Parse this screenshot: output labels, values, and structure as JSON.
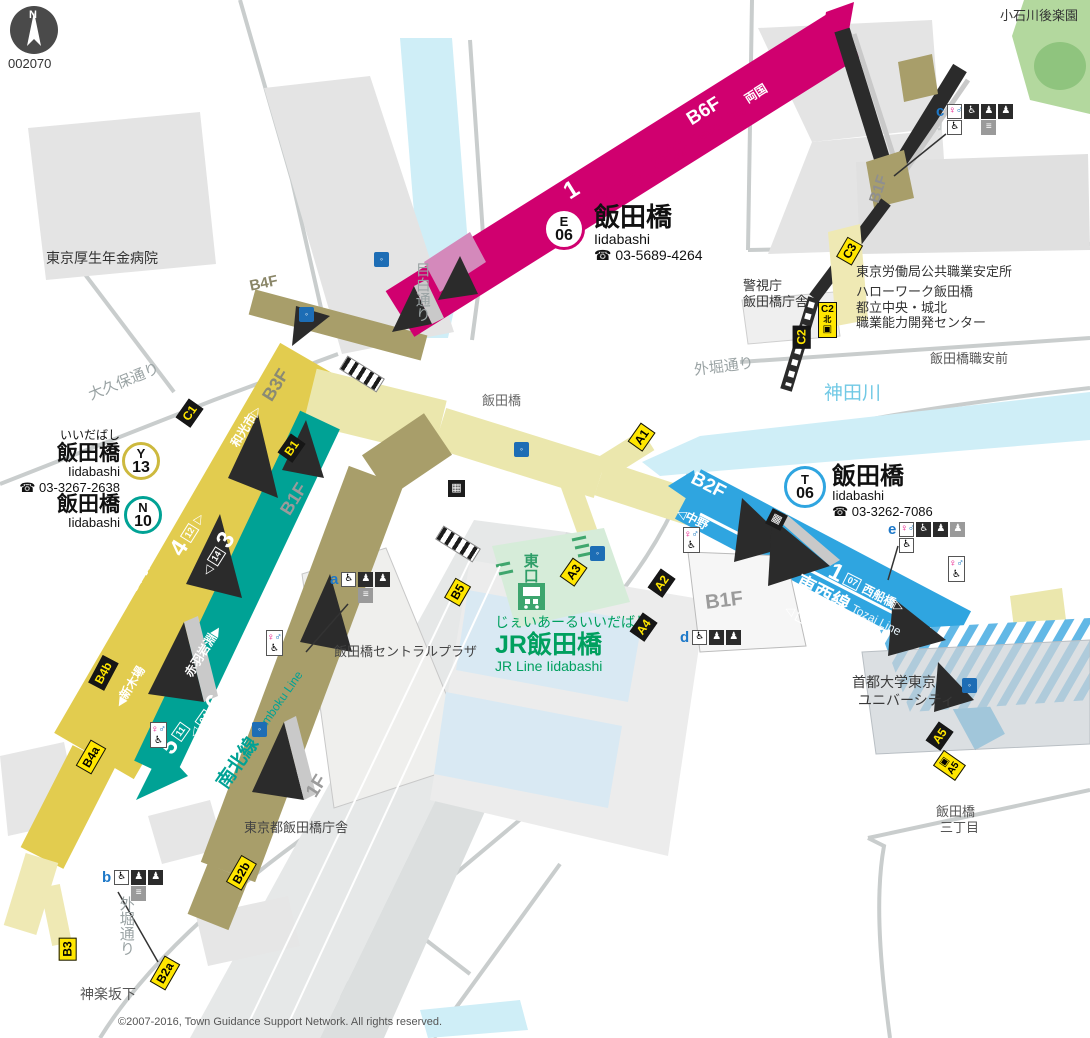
{
  "compass": {
    "n": "N",
    "code": "002070"
  },
  "copyright": "©2007-2016, Town Guidance Support Network. All rights reserved.",
  "glyphs": {
    "tri_l": "◁",
    "tri_r": "▷",
    "tri_l_solid": "◀",
    "tri_r_solid": "▶"
  },
  "icons": {
    "female": "♀",
    "male": "♂",
    "wheelchair": "♿",
    "locker": "▦",
    "person": "♟",
    "stairs": "≡",
    "elevator": "▣",
    "water": "◦",
    "train_label": "JR"
  },
  "stations": {
    "oedo": {
      "symbol": "E",
      "number": "06",
      "name": "飯田橋",
      "romaji": "Iidabashi",
      "phone": "☎ 03-5689-4264"
    },
    "yurakucho": {
      "symbol": "Y",
      "number": "13",
      "kana": "いいだばし",
      "name": "飯田橋",
      "romaji": "Iidabashi",
      "phone": "☎ 03-3267-2638"
    },
    "namboku": {
      "symbol": "N",
      "number": "10",
      "name": "飯田橋",
      "romaji": "Iidabashi"
    },
    "tozai": {
      "symbol": "T",
      "number": "06",
      "name": "飯田橋",
      "romaji": "Iidabashi",
      "phone": "☎ 03-3262-7086"
    },
    "jr": {
      "kana": "じぇいあーるいいだばし",
      "name": "JR飯田橋",
      "romaji": "JR Line Iidabashi",
      "east_exit": "東口"
    }
  },
  "lines": {
    "oedo": {
      "name": "都営大江戸線",
      "name_en": "Oedo Line",
      "floor": "B6F",
      "platform_2": "2",
      "platform_1": "1",
      "car_07": "07",
      "dir_left": "◁都庁前",
      "dir_right": "両国"
    },
    "yurakucho": {
      "name": "有楽町線",
      "name_en": "Yurakucho Line",
      "floor": "B3F",
      "platform_4": "4",
      "platform_3": "3",
      "car_12": "12",
      "car_14": "14",
      "dir_up": "和光市▷",
      "dir_down": "◀新木場"
    },
    "namboku": {
      "name": "南北線",
      "name_en": "Namboku Line",
      "platform_5": "5",
      "platform_6": "6",
      "car_11": "11",
      "car_04": "04",
      "dir_up": "赤羽岩淵▶",
      "dir_down": "◁目黒"
    },
    "tozai": {
      "name": "東西線",
      "name_en": "Tozai Line",
      "floor": "B2F",
      "platform_1": "1",
      "platform_2": "2",
      "car_07": "07",
      "car_05": "05",
      "dir_left": "◁中野",
      "dir_right": "西船橋▷"
    }
  },
  "floors": {
    "b4f": "B4F",
    "b1f_yurakucho": "B1F",
    "b1f_shaft": "B1F",
    "b1f_tozai": "B1F",
    "f1": "1F"
  },
  "exits": {
    "a1": "A1",
    "a2": "A2",
    "a3": "A3",
    "a4": "A4",
    "a5": "A5",
    "a5_elev": "A5",
    "b1": "B1",
    "b2a": "B2a",
    "b2b": "B2b",
    "b3": "B3",
    "b4a": "B4a",
    "b4b": "B4b",
    "b5": "B5",
    "c1": "C1",
    "c2": "C2",
    "c2_elev": "C2",
    "c3": "C3",
    "north": "北"
  },
  "facilities": {
    "a": "a",
    "b": "b",
    "c": "c",
    "d": "d",
    "e": "e"
  },
  "places": {
    "hospital": "東京厚生年金病院",
    "park": "小石川後楽園",
    "police1": "警視庁",
    "police2": "飯田橋庁舎",
    "labor1": "東京労働局公共職業安定所",
    "labor2": "ハローワーク飯田橋",
    "labor3": "都立中央・城北",
    "labor4": "職業能力開発センター",
    "shokuan_mae": "飯田橋職安前",
    "central_plaza": "飯田橋セントラルプラザ",
    "city_office": "東京都飯田橋庁舎",
    "university1": "首都大学東京",
    "university2": "ユニバーシティ",
    "sanchome1": "飯田橋",
    "sanchome2": "三丁目",
    "kagurazaka": "神楽坂下"
  },
  "streets": {
    "okubo": "大久保通り",
    "mejiro": "目白通り",
    "sotobori_top": "外堀通り",
    "sotobori_bottom": "外堀通り",
    "kanda_river": "神田川",
    "iidabashi_bridge": "飯田橋"
  }
}
